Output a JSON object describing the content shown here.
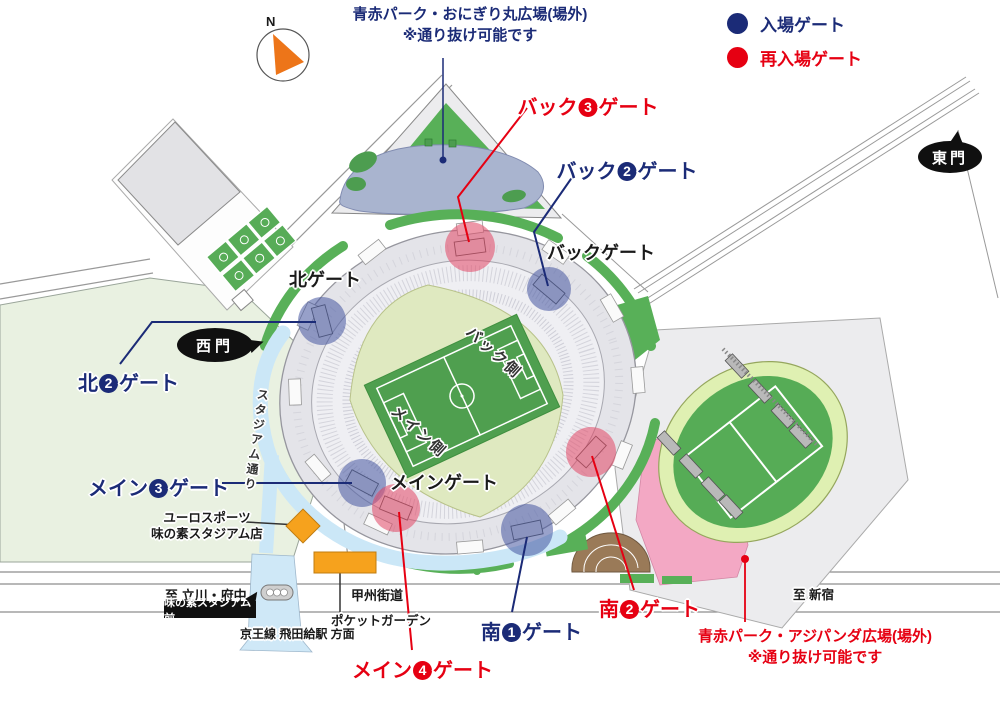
{
  "compass": {
    "label": "N"
  },
  "legend": {
    "items": [
      {
        "label": "入場ゲート",
        "color": "#1b2b77"
      },
      {
        "label": "再入場ゲート",
        "color": "#e60012"
      }
    ]
  },
  "notes": {
    "onigiri": {
      "line1": "青赤パーク・おにぎり丸広場(場外)",
      "line2": "※通り抜け可能です"
    },
    "ajipanda": {
      "line1": "青赤パーク・アジパンダ広場(場外)",
      "line2": "※通り抜け可能です"
    }
  },
  "gate_labels": {
    "back3": {
      "prefix": "バック",
      "number": "3",
      "suffix": "ゲート"
    },
    "back2": {
      "prefix": "バック",
      "number": "2",
      "suffix": "ゲート"
    },
    "back_gate": "バックゲート",
    "north_gate": "北ゲート",
    "north2": {
      "prefix": "北",
      "number": "2",
      "suffix": "ゲート"
    },
    "main3": {
      "prefix": "メイン",
      "number": "3",
      "suffix": "ゲート"
    },
    "main4": {
      "prefix": "メイン",
      "number": "4",
      "suffix": "ゲート"
    },
    "main_gate": "メインゲート",
    "south1": {
      "prefix": "南",
      "number": "1",
      "suffix": "ゲート"
    },
    "south2": {
      "prefix": "南",
      "number": "2",
      "suffix": "ゲート"
    }
  },
  "badges": {
    "east_gate": "東門",
    "west_gate": "西門",
    "bus_stop": "味の素スタジアム前"
  },
  "roads": {
    "koshu_kaido": "甲州街道",
    "stadium_street": "スタジアム通り",
    "to_tachikawa_fuchu": "至 立川・府中",
    "to_shinjuku": "至 新宿",
    "keio_line": "京王線 飛田給駅 方面"
  },
  "places": {
    "euro_sports": {
      "line1": "ユーロスポーツ",
      "line2": "味の素スタジアム店"
    },
    "pocket_garden": "ポケットガーデン",
    "stadium_back_side": "バック側",
    "stadium_main_side": "メイン側"
  }
}
